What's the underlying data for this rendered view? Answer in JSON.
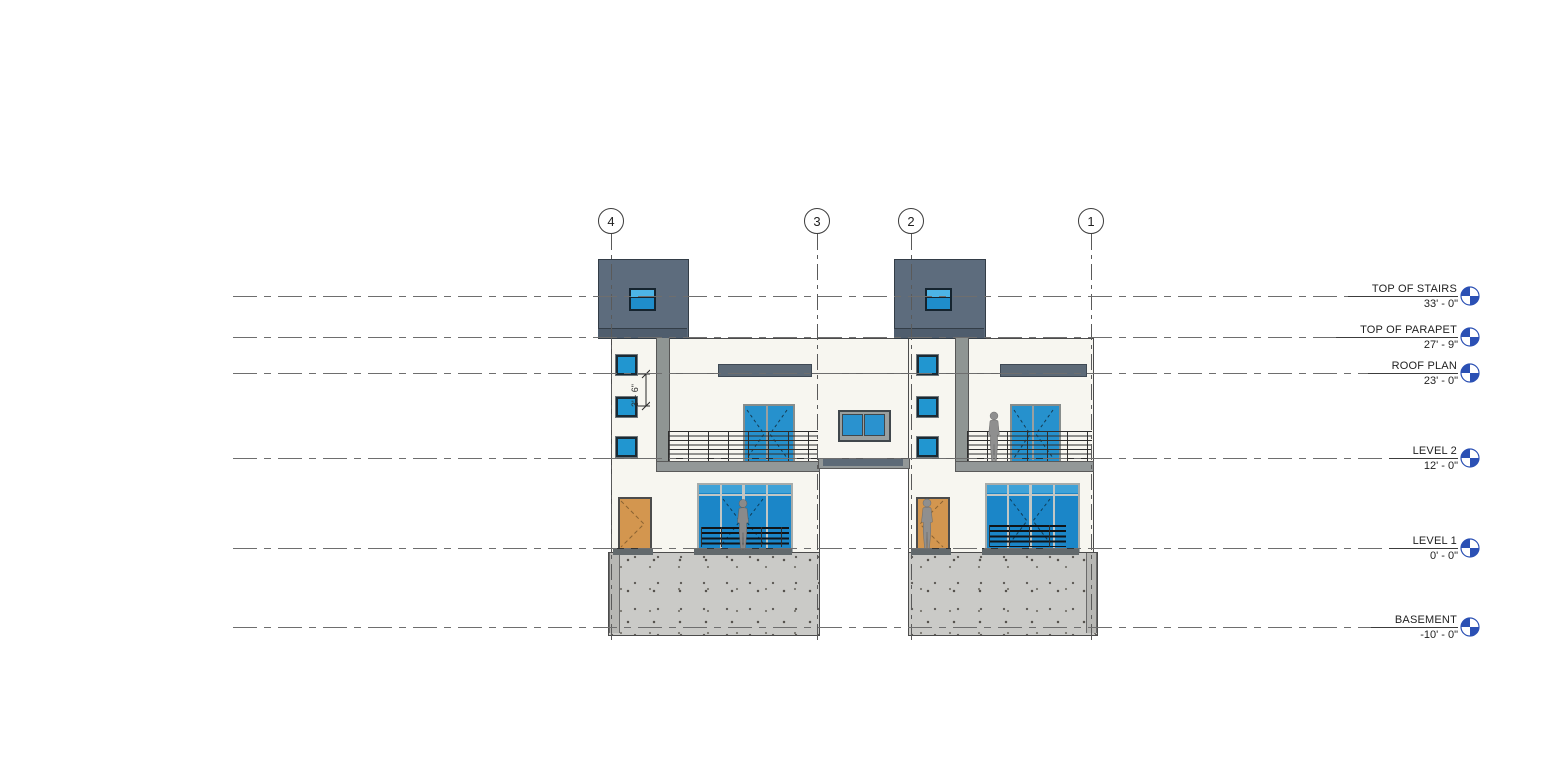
{
  "grids": [
    {
      "label": "4"
    },
    {
      "label": "3"
    },
    {
      "label": "2"
    },
    {
      "label": "1"
    }
  ],
  "levels": [
    {
      "name": "TOP OF STAIRS",
      "elevation": "33' - 0\""
    },
    {
      "name": "TOP OF PARAPET",
      "elevation": "27' - 9\""
    },
    {
      "name": "ROOF PLAN",
      "elevation": "23' - 0\""
    },
    {
      "name": "LEVEL 2",
      "elevation": "12' - 0\""
    },
    {
      "name": "LEVEL 1",
      "elevation": "0' - 0\""
    },
    {
      "name": "BASEMENT",
      "elevation": "-10' - 0\""
    }
  ],
  "dimension": {
    "value": "3' - 6\""
  },
  "colors": {
    "glass_blue": "#1b86c8",
    "datum_blue": "#2b50b4",
    "penthouse_gray": "#5d6c7d",
    "facade": "#f7f6f0",
    "foundation": "#cacac7",
    "slab_gray": "#939898",
    "band_dark": "#5d6a77",
    "door_wood": "#d3964f"
  }
}
